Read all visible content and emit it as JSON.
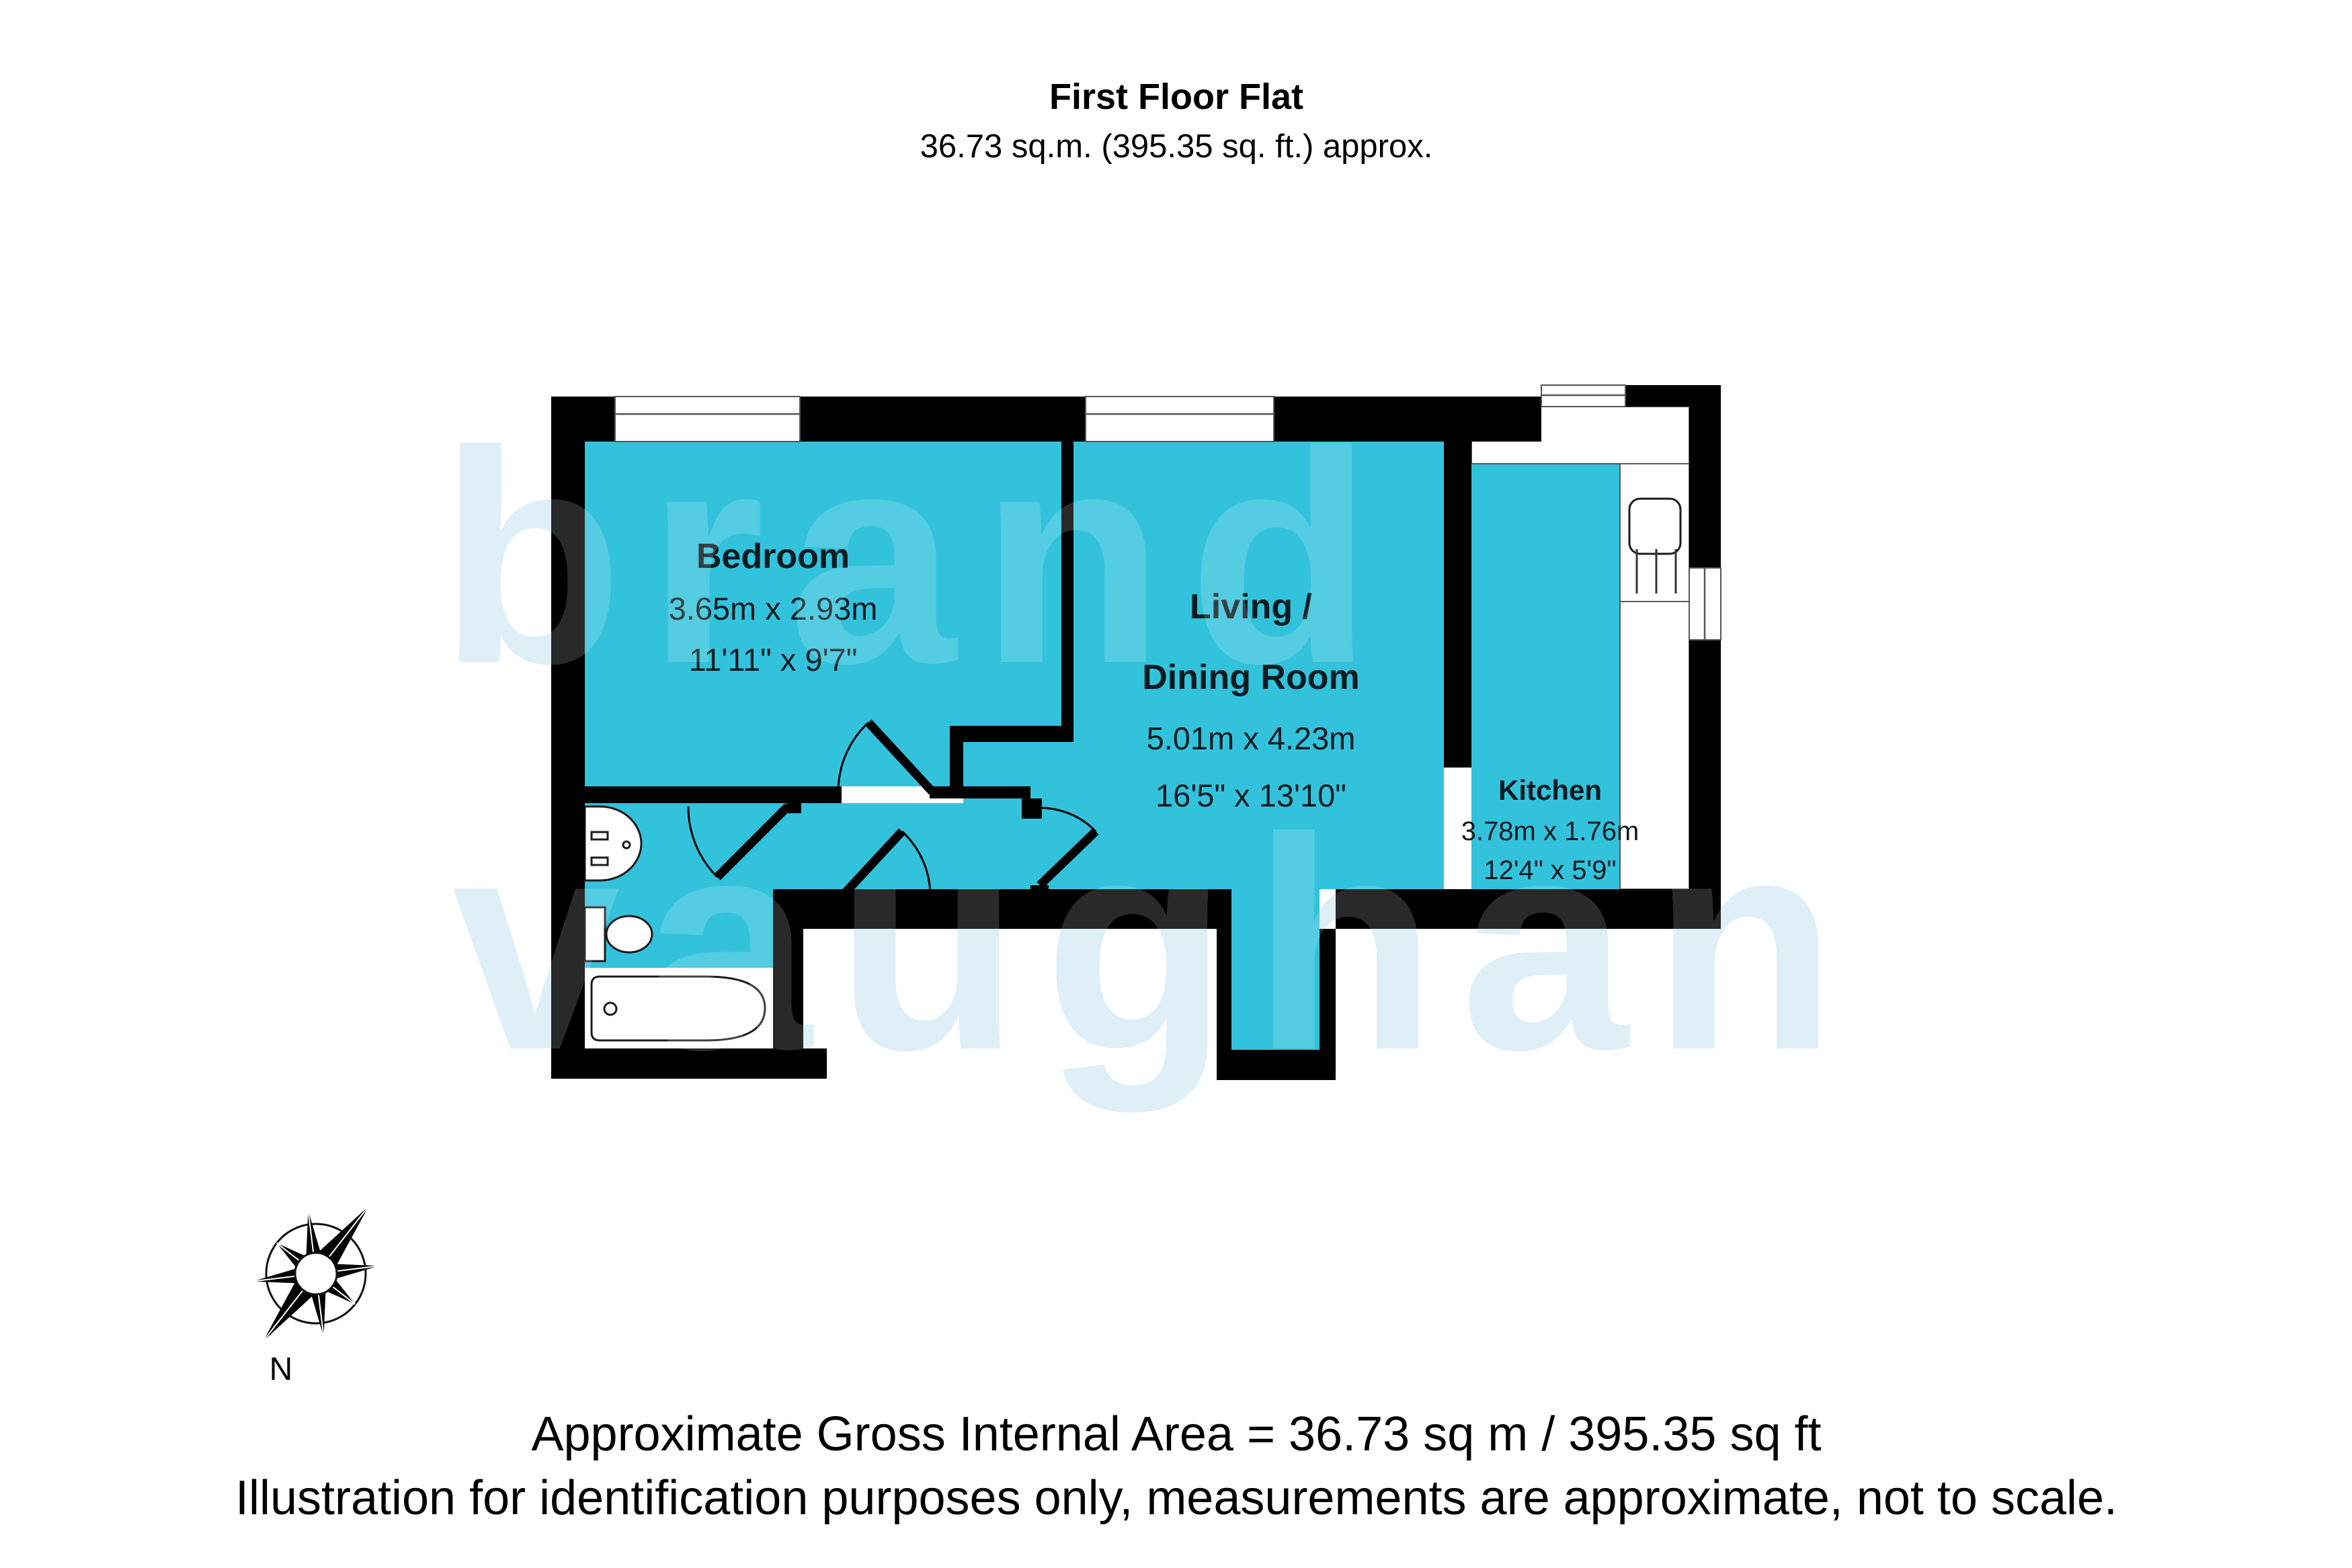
{
  "title": {
    "line1": "First Floor Flat",
    "line2": "36.73 sq.m. (395.35 sq. ft.) approx."
  },
  "rooms": {
    "bedroom": {
      "name": "Bedroom",
      "metric": "3.65m x 2.93m",
      "imperial": "11'11\" x 9'7\""
    },
    "living": {
      "name_line1": "Living /",
      "name_line2": "Dining Room",
      "metric": "5.01m x 4.23m",
      "imperial": "16'5\" x 13'10\""
    },
    "kitchen": {
      "name": "Kitchen",
      "metric": "3.78m x 1.76m",
      "imperial": "12'4\" x 5'9\""
    }
  },
  "compass": {
    "label": "N"
  },
  "footer": {
    "line1": "Approximate Gross Internal Area = 36.73 sq m / 395.35 sq ft",
    "line2": "Illustration for identification purposes only, measurements are approximate, not to scale."
  },
  "watermark": {
    "line1": "brand",
    "line2": "vaughan"
  },
  "colors": {
    "room-fill": "#33C2DC",
    "wall": "#000000",
    "watermark": "#D9EDF6"
  }
}
